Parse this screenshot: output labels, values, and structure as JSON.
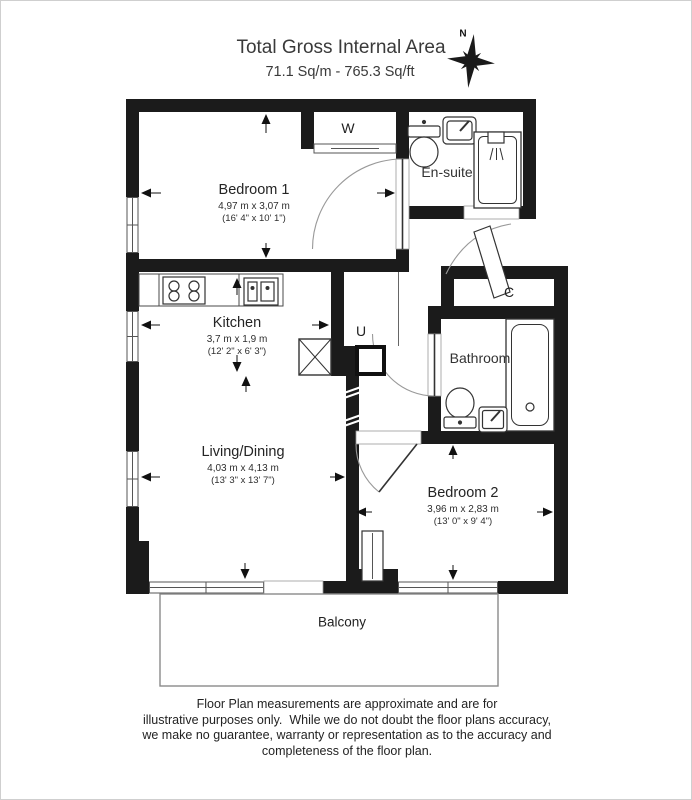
{
  "header": {
    "title": "Total Gross Internal Area",
    "subtitle": "71.1 Sq/m - 765.3 Sq/ft"
  },
  "compass": {
    "north_label": "N"
  },
  "rooms": {
    "bedroom1": {
      "name": "Bedroom 1",
      "dims_m": "4,97 m x 3,07 m",
      "dims_ft": "(16' 4\" x 10' 1\")"
    },
    "kitchen": {
      "name": "Kitchen",
      "dims_m": "3,7 m x 1,9 m",
      "dims_ft": "(12' 2\" x 6' 3\")"
    },
    "living_dining": {
      "name": "Living/Dining",
      "dims_m": "4,03 m x 4,13 m",
      "dims_ft": "(13' 3\" x 13' 7\")"
    },
    "bedroom2": {
      "name": "Bedroom 2",
      "dims_m": "3,96 m x 2,83 m",
      "dims_ft": "(13' 0\" x 9' 4\")"
    },
    "ensuite": {
      "name": "En-suite"
    },
    "bathroom": {
      "name": "Bathroom"
    },
    "balcony": {
      "name": "Balcony"
    },
    "wardrobe": {
      "label": "W"
    },
    "utility": {
      "label": "U"
    },
    "cupboard": {
      "label": "C"
    }
  },
  "disclaimer": {
    "lines": [
      "Floor Plan measurements are approximate and are for",
      "illustrative purposes only.  While we do not doubt the floor plans accuracy,",
      "we make no guarantee, warranty or representation as to the accuracy and",
      "completeness of the floor plan."
    ]
  },
  "colors": {
    "walls": "#1b1b1b",
    "fixture_stroke": "#333333",
    "door_arc": "#999999",
    "frame_border": "#cfcfcf"
  }
}
